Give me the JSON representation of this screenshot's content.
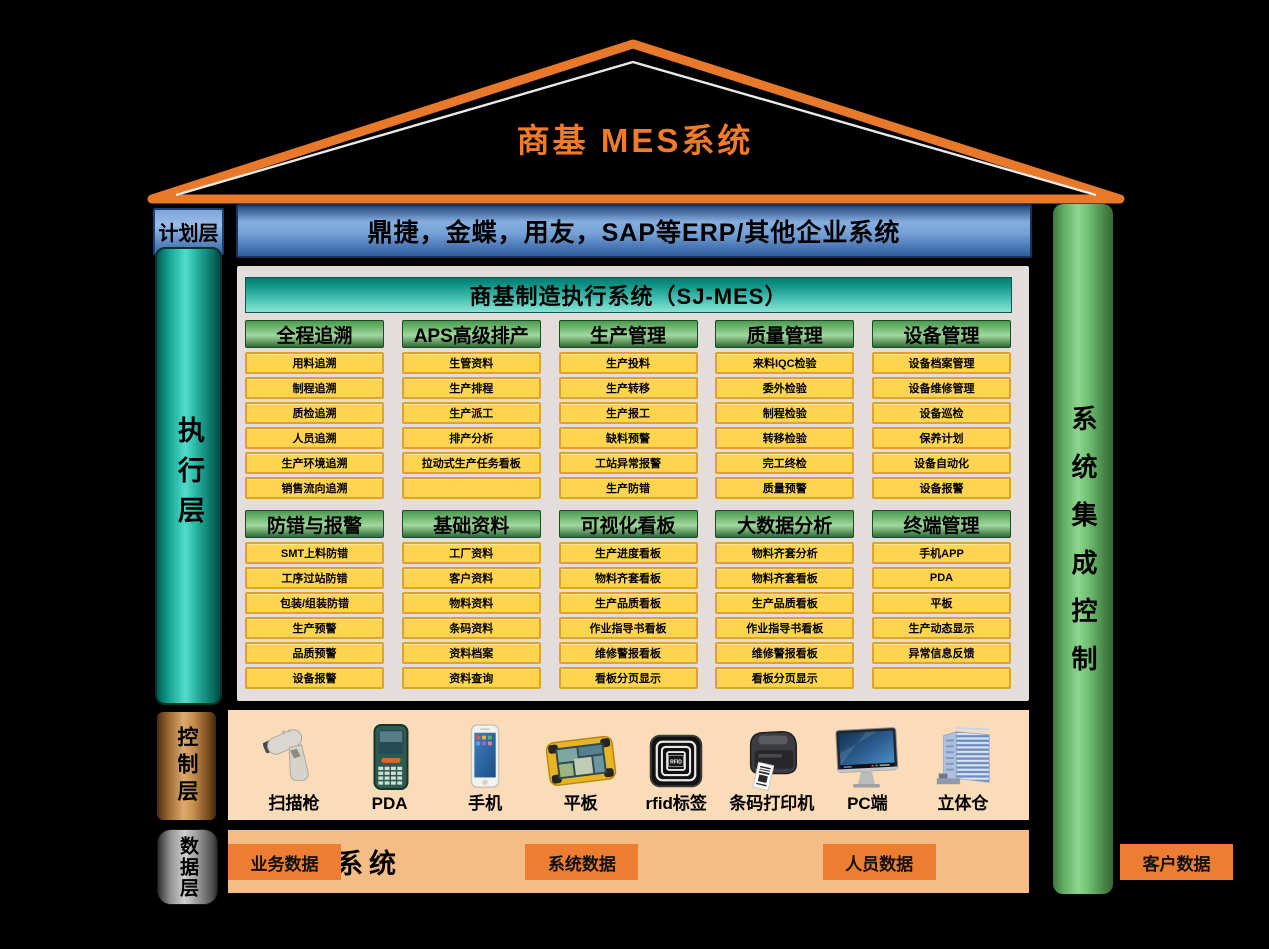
{
  "title": "商基  MES系统",
  "plan_layer": {
    "label": "计划层",
    "erp_text": "鼎捷，金蝶，用友，SAP等ERP/其他企业系统"
  },
  "execution_layer": {
    "label": "执行层",
    "header": "商基制造执行系统（SJ-MES）",
    "rows": [
      [
        {
          "title": "全程追溯",
          "items": [
            "用料追溯",
            "制程追溯",
            "质检追溯",
            "人员追溯",
            "生产环境追溯",
            "销售流向追溯"
          ]
        },
        {
          "title": "APS高级排产",
          "items": [
            "生管资料",
            "生产排程",
            "生产派工",
            "排产分析",
            "拉动式生产任务看板",
            ""
          ]
        },
        {
          "title": "生产管理",
          "items": [
            "生产投料",
            "生产转移",
            "生产报工",
            "缺料预警",
            "工站异常报警",
            "生产防错"
          ]
        },
        {
          "title": "质量管理",
          "items": [
            "来料IQC检验",
            "委外检验",
            "制程检验",
            "转移检验",
            "完工终检",
            "质量预警"
          ]
        },
        {
          "title": "设备管理",
          "items": [
            "设备档案管理",
            "设备维修管理",
            "设备巡检",
            "保养计划",
            "设备自动化",
            "设备报警"
          ]
        }
      ],
      [
        {
          "title": "防错与报警",
          "items": [
            "SMT上料防错",
            "工序过站防错",
            "包装/组装防错",
            "生产预警",
            "品质预警",
            "设备报警"
          ]
        },
        {
          "title": "基础资料",
          "items": [
            "工厂资料",
            "客户资料",
            "物料资料",
            "条码资料",
            "资料档案",
            "资料查询"
          ]
        },
        {
          "title": "可视化看板",
          "items": [
            "生产进度看板",
            "物料齐套看板",
            "生产品质看板",
            "作业指导书看板",
            "维修警报看板",
            "看板分页显示"
          ]
        },
        {
          "title": "大数据分析",
          "items": [
            "物料齐套分析",
            "物料齐套看板",
            "生产品质看板",
            "作业指导书看板",
            "维修警报看板",
            "看板分页显示"
          ]
        },
        {
          "title": "终端管理",
          "items": [
            "手机APP",
            "PDA",
            "平板",
            "生产动态显示",
            "异常信息反馈",
            ""
          ]
        }
      ]
    ]
  },
  "control_layer": {
    "label": "控制层",
    "devices": [
      {
        "label": "扫描枪",
        "icon": "scanner-icon"
      },
      {
        "label": "PDA",
        "icon": "pda-icon"
      },
      {
        "label": "手机",
        "icon": "phone-icon"
      },
      {
        "label": "平板",
        "icon": "tablet-icon"
      },
      {
        "label": "rfid标签",
        "icon": "rfid-icon",
        "chip_text": "RFID"
      },
      {
        "label": "条码打印机",
        "icon": "barcode-printer-icon"
      },
      {
        "label": "PC端",
        "icon": "pc-icon"
      },
      {
        "label": "立体仓",
        "icon": "warehouse-icon"
      }
    ]
  },
  "data_layer": {
    "label": "数据层",
    "system_label": "数据系统",
    "buttons": [
      "业务数据",
      "系统数据",
      "人员数据",
      "客户数据"
    ]
  },
  "right_bar": {
    "label": "系统集成控制"
  },
  "colors": {
    "roof_orange": "#E8782A",
    "title_orange": "#F07B28",
    "erp_blue": "#74A1D6",
    "sj_teal": "#55C9BA",
    "group_green": "#77BC77",
    "cell_yellow": "#FFD44E",
    "cell_border": "#E2A02F",
    "exec_panel_gray": "#E3DEDC",
    "control_bg": "#FBDCB8",
    "data_bg": "#F5BD86",
    "data_button_orange": "#ED7D31",
    "right_bar_green": "#8ED690"
  }
}
